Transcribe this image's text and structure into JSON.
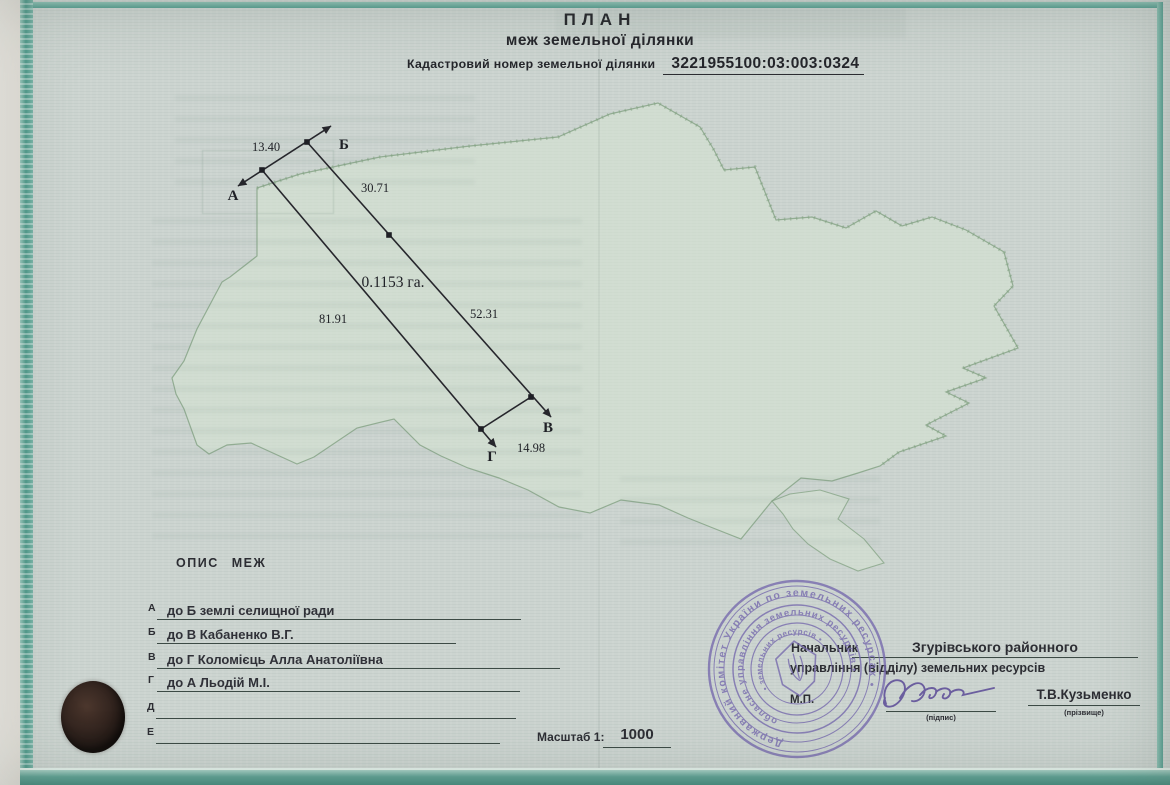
{
  "header": {
    "title": "ПЛАН",
    "subtitle": "меж земельної ділянки",
    "cadastral_label": "Кадастровий номер земельної ділянки",
    "cadastral_number": "3221955100:03:003:0324"
  },
  "plan": {
    "area": "0.1153 га.",
    "vertex_a": "А",
    "vertex_b": "Б",
    "vertex_v": "В",
    "vertex_g": "Г",
    "len_ab": "13.40",
    "len_b_seg1": "30.71",
    "len_b_seg2": "52.31",
    "len_ag": "81.91",
    "len_vg": "14.98"
  },
  "boundaries": {
    "heading": "ОПИС МЕЖ",
    "rows": [
      {
        "letter": "А",
        "text": "до Б землі селищної ради"
      },
      {
        "letter": "Б",
        "text": "до В Кабаненко В.Г."
      },
      {
        "letter": "В",
        "text": "до Г Коломієць Алла Анатоліївна"
      },
      {
        "letter": "Г",
        "text": "до А Льодій М.І."
      },
      {
        "letter": "Д",
        "text": ""
      },
      {
        "letter": "Е",
        "text": ""
      }
    ]
  },
  "scale": {
    "label": "Масштаб 1:",
    "value": "1000"
  },
  "officials": {
    "position": "Начальник",
    "office_name": "Згурівського районного",
    "office_line2": "управління (відділу) земельних ресурсів",
    "seal_place": "М.П.",
    "signature_caption": "(підпис)",
    "surname": "Т.В.Кузьменко",
    "surname_caption": "(прізвище)"
  },
  "stamp": {
    "outer_text": "Державний комітет України по земельних ресурсах •",
    "middle_text": "обласне управління земельних ресурсів •",
    "inner_text": "• земельних ресурсів •"
  },
  "icons": {
    "map_watermark": "ukraine-outline",
    "official_stamp": "round-purple-seal",
    "wax_seal": "dark-wax-seal"
  },
  "colors": {
    "paper": "#ccd4d0",
    "border_teal": "#4f9a8b",
    "map_green": "#8fae92",
    "ink": "#25262b",
    "stamp_purple": "#7568ad"
  }
}
